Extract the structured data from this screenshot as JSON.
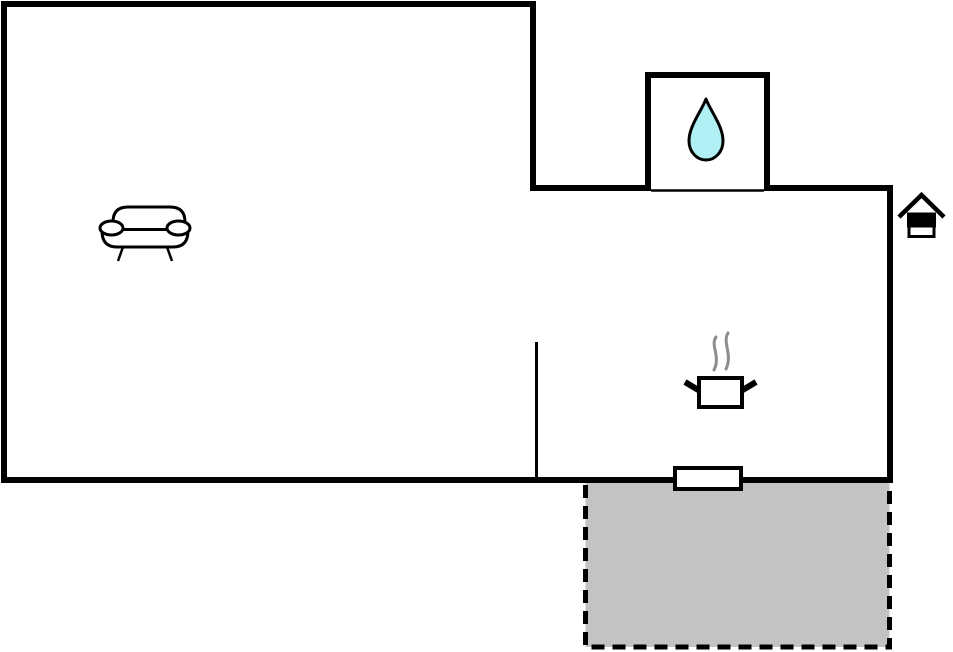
{
  "canvas": {
    "width": 953,
    "height": 652,
    "background": "#ffffff"
  },
  "palette": {
    "wall": "#000000",
    "room_fill": "#ffffff",
    "terrace_fill": "#c3c3c3",
    "terrace_border": "#000000",
    "water_drop": "#b0f0f4",
    "steam": "#8d8d8d",
    "icon_stroke": "#000000"
  },
  "floorplan": {
    "type": "holiday-home-floor-plan",
    "rooms": [
      {
        "name": "living-room",
        "feature": "sofa",
        "position": "left"
      },
      {
        "name": "bathroom",
        "feature": "water-drop",
        "position": "top-right-annex"
      },
      {
        "name": "kitchen",
        "feature": "cooking-pot-with-steam",
        "position": "right"
      },
      {
        "name": "terrace",
        "feature": "dashed-gray-outdoor-area",
        "position": "bottom-right-outside"
      }
    ],
    "openings": [
      {
        "name": "bathroom-opening",
        "type": "wall-opening"
      },
      {
        "name": "terrace-door",
        "type": "door"
      }
    ],
    "markers": [
      {
        "name": "entrance",
        "icon": "house-entrance-icon",
        "position": "outside-right-wall"
      }
    ]
  }
}
